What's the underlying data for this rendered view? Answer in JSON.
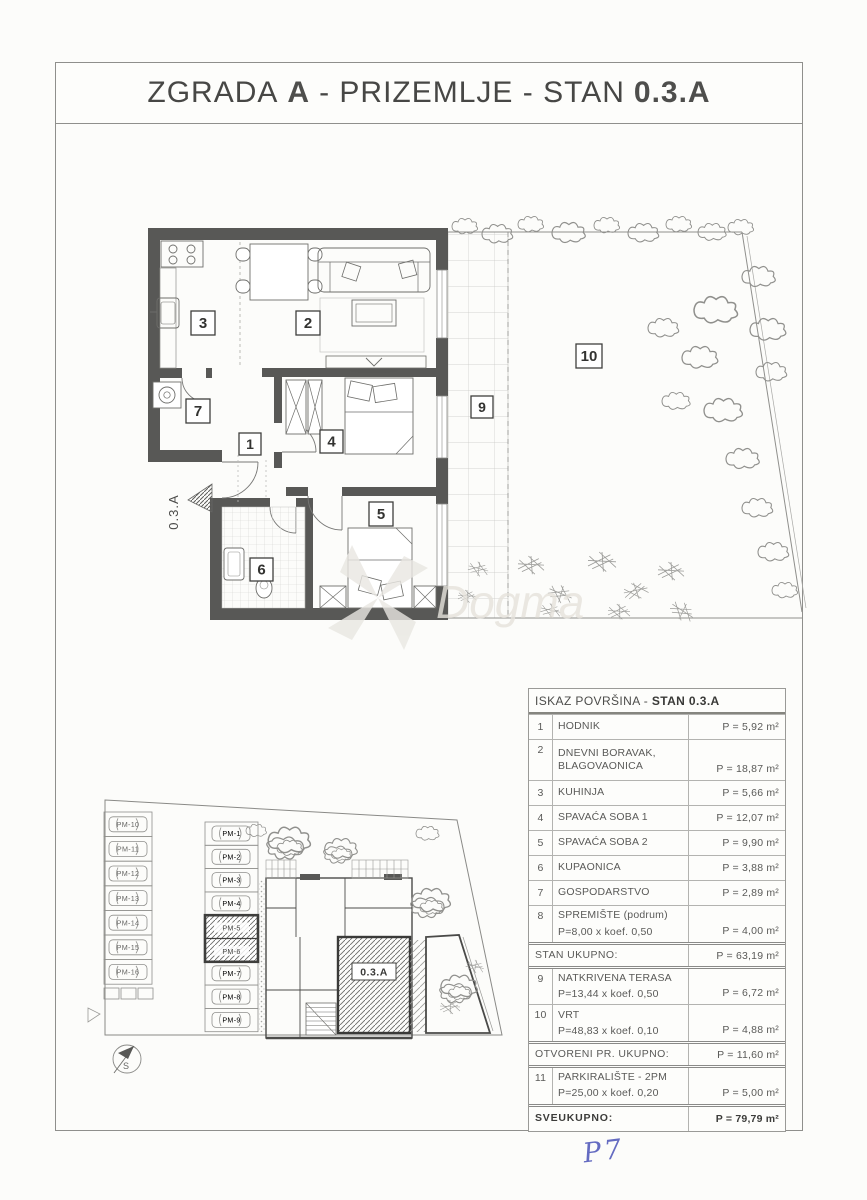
{
  "page": {
    "title": {
      "part1": "ZGRADA",
      "bold1": "A",
      "part2": "- PRIZEMLJE - STAN",
      "bold2": "0.3.A"
    }
  },
  "floor_plan": {
    "unit_label": "0.3.A",
    "room_numbers": [
      "1",
      "2",
      "3",
      "4",
      "5",
      "6",
      "7",
      "9",
      "10"
    ]
  },
  "site_plan": {
    "unit_label": "0.3.A",
    "north_label": "S",
    "parking_left": [
      "PM-10",
      "PM-11",
      "PM-12",
      "PM-13",
      "PM-14",
      "PM-15",
      "PM-16"
    ],
    "parking_right": [
      "PM-1",
      "PM-2",
      "PM-3",
      "PM-4",
      "PM-5",
      "PM-6",
      "PM-7",
      "PM-8",
      "PM-9"
    ],
    "highlighted_spots": [
      "PM-5",
      "PM-6"
    ]
  },
  "area_table": {
    "header_prefix": "ISKAZ POVRŠINA - ",
    "header_bold": "STAN 0.3.A",
    "rows": [
      {
        "num": "1",
        "name": "HODNIK",
        "value": "P = 5,92 m²"
      },
      {
        "num": "2",
        "name": "DNEVNI BORAVAK, BLAGOVAONICA",
        "value": "P = 18,87 m²"
      },
      {
        "num": "3",
        "name": "KUHINJA",
        "value": "P = 5,66 m²"
      },
      {
        "num": "4",
        "name": "SPAVAĆA SOBA 1",
        "value": "P = 12,07 m²"
      },
      {
        "num": "5",
        "name": "SPAVAĆA SOBA 2",
        "value": "P = 9,90 m²"
      },
      {
        "num": "6",
        "name": "KUPAONICA",
        "value": "P = 3,88 m²"
      },
      {
        "num": "7",
        "name": "GOSPODARSTVO",
        "value": "P = 2,89 m²"
      },
      {
        "num": "8",
        "name": "SPREMIŠTE (podrum)",
        "formula": "P=8,00 x koef. 0,50",
        "value": "P = 4,00 m²"
      }
    ],
    "stan_ukupno": {
      "label": "STAN UKUPNO:",
      "value": "P = 63,19 m²"
    },
    "rows_open": [
      {
        "num": "9",
        "name": "NATKRIVENA TERASA",
        "formula": "P=13,44 x koef. 0,50",
        "value": "P = 6,72 m²"
      },
      {
        "num": "10",
        "name": "VRT",
        "formula": "P=48,83 x koef. 0,10",
        "value": "P = 4,88 m²"
      }
    ],
    "otvoreni": {
      "label": "OTVORENI PR. UKUPNO:",
      "value": "P = 11,60 m²"
    },
    "row_parking": {
      "num": "11",
      "name": "PARKIRALIŠTE - 2PM",
      "formula": "P=25,00 x koef. 0,20",
      "value": "P = 5,00 m²"
    },
    "sveukupno": {
      "label": "SVEUKUPNO:",
      "value": "P = 79,79 m²"
    }
  },
  "watermark": "Dogma",
  "annotations": {
    "handwritten": "P7"
  }
}
